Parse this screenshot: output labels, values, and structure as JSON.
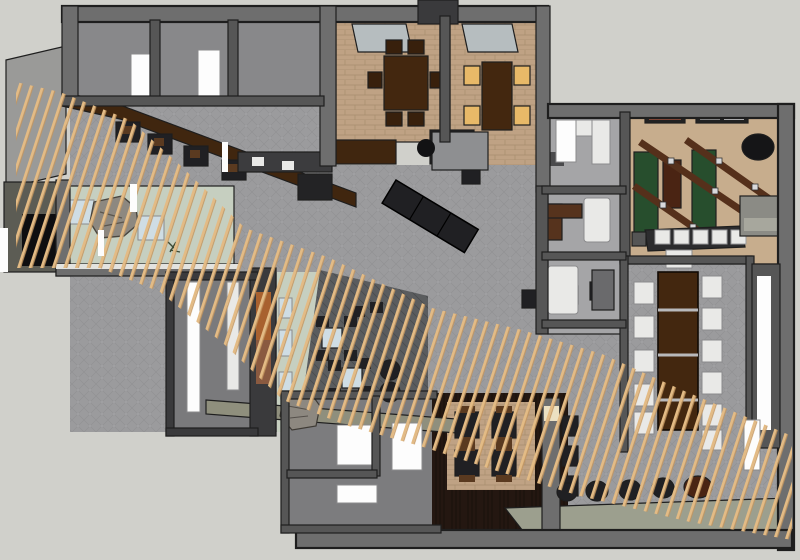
{
  "scene": {
    "type": "overhead-3d-floorplan-render",
    "subject": "restaurant-interior-plan",
    "signature_feature": "diagonal-wood-slat-canopy"
  },
  "colors": {
    "background": "#d0d0cb",
    "roof_plane": "#9a9a98",
    "outline": "#1e1e1e",
    "wall_top": "#6e6e6e",
    "wall_mid": "#565656",
    "wall_dark": "#3a3a3c",
    "room_gray": "#88888a",
    "office_floor": "#a5a5a7",
    "carpet": "#9b9b9d",
    "carpet_hatch": "#8b8b8e",
    "carpet_dot": "#a9a9ab",
    "brick": "#bfa284",
    "brick_line": "#a28868",
    "tan_carpet": "#c7ad8d",
    "sage": "#c6cfc0",
    "walkway": "#8f8f7d",
    "khaki_band": "#9c9f8e",
    "lounge_floor": "#5a5c5e",
    "wood_floor": "#241711",
    "wood_bar": "#40260f",
    "wood_table": "#43270f",
    "black_furn": "#202023",
    "green_table": "#274e2d",
    "blue_seat": "#cfdde4",
    "white_furn": "#e9e9e7",
    "offwhite": "#fdfdfd",
    "amber": "#e8b968",
    "skylight": "#b6bdbf",
    "art_orange": "#a8612f",
    "art_brown": "#8a5a40",
    "rock": "#8d8880",
    "beam": "#55301b",
    "barrel_brown": "#4a2413",
    "station": "#8e8f91",
    "cream": "#ece0c2",
    "slat": "#e3bb85",
    "slat_shadow": "#c2945c"
  },
  "slat_canopy": {
    "angle_deg": 18,
    "spacing_px": 11,
    "slat_width_px": 2.8
  },
  "inventory": {
    "private_dining_rooms": 2,
    "skylights": 2,
    "dining_chairs_room1": 6,
    "amber_lit_chairs_room2": 4,
    "communal_table_chairs": 12,
    "game_tables_green": 2,
    "game_tables_brown": 1,
    "ceiling_beams": 3,
    "bar_stools_white": 5,
    "wall_art_pieces": 2,
    "lounge_tables": 2,
    "lounge_poufs": 2,
    "wall_benches_blue": 3,
    "entry_cube_seats": 2,
    "entry_boulders": 1,
    "booth_tables": 4,
    "barrels_black": 4,
    "barrels_brown": 1,
    "restroom_fixtures": 3,
    "cafe_table_clusters": 4,
    "center_tables": 3,
    "black_sofa_sections": 3
  }
}
